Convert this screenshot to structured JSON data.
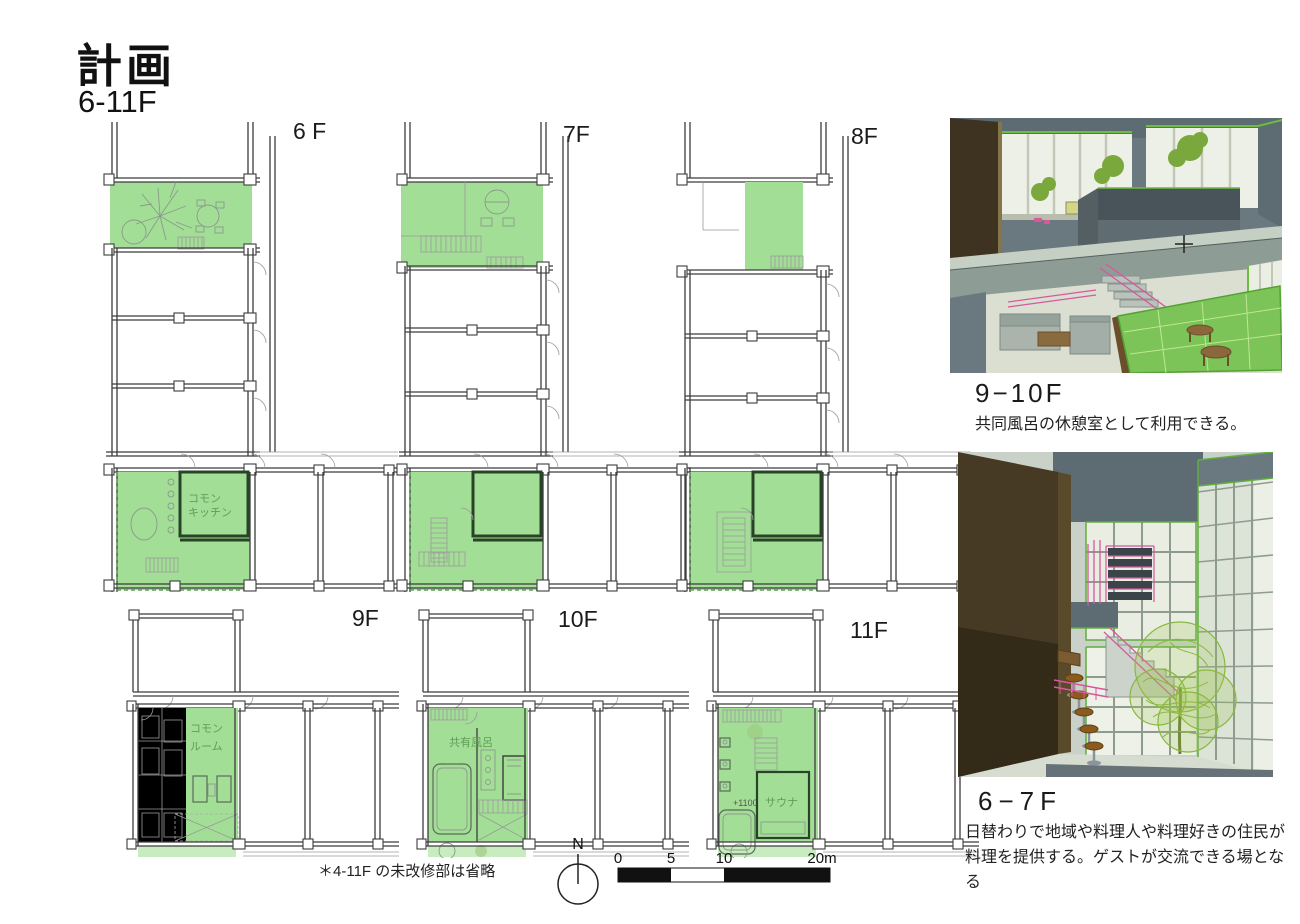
{
  "page": {
    "title": "計画",
    "subtitle": "6-11F"
  },
  "colors": {
    "plan_highlight_green": "#a3de97",
    "plan_apron_green": "#c8ecbf",
    "plan_tatami_gray": "#ccd5d5",
    "render_wall_gray": "#6a7980",
    "render_wood_brown": "#463a24",
    "render_tatami_green": "#7cc457",
    "render_stair_pink": "#d8579e",
    "render_tree_green": "#8ab83e"
  },
  "plans": {
    "f6": {
      "label": "6 F",
      "room_line1": "コモン",
      "room_line2": "キッチン"
    },
    "f7": {
      "label": "7F"
    },
    "f8": {
      "label": "8F"
    },
    "f9": {
      "label": "9F",
      "room_line1": "コモン",
      "room_line2": "ルーム"
    },
    "f10": {
      "label": "10F",
      "room_label": "共有風呂"
    },
    "f11": {
      "label": "11F",
      "room_label": "サウナ",
      "level_note": "+1100"
    }
  },
  "renders": {
    "upper": {
      "caption": "9−10F",
      "description": "共同風呂の休憩室として利用できる。"
    },
    "lower": {
      "caption": "6−7F",
      "description_line1": "日替わりで地域や料理人や料理好きの住民が",
      "description_line2": "料理を提供する。ゲストが交流できる場となる"
    }
  },
  "footer": {
    "note": "＊4-11F の未改修部は省略",
    "north_label": "N",
    "scale_ticks": [
      "0",
      "5",
      "10",
      "20m"
    ]
  }
}
